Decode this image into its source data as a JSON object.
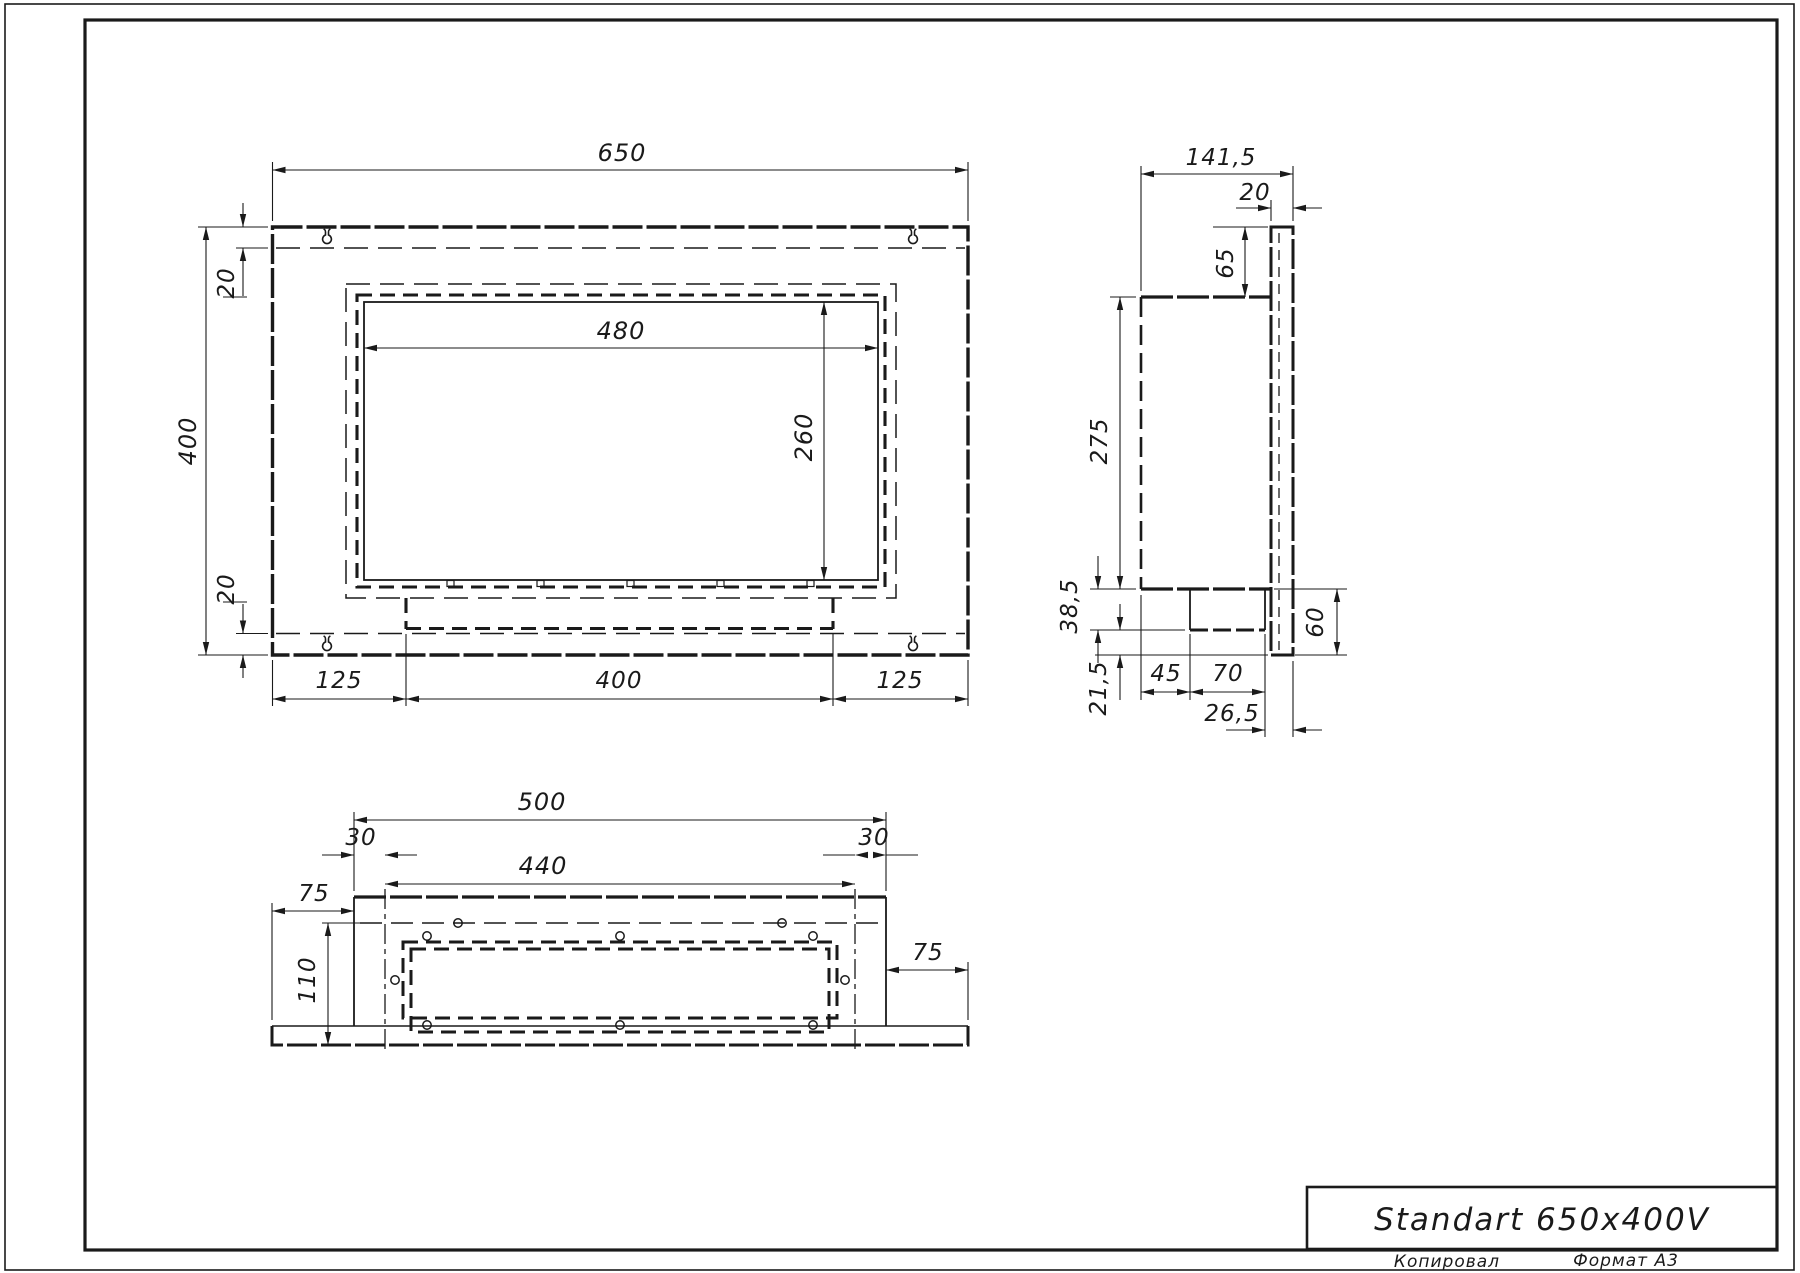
{
  "title_block": {
    "title": "Standart 650x400V"
  },
  "sheet": {
    "copied_label": "Копировал",
    "format_label": "Формат A3"
  },
  "views": {
    "front": {
      "width": "650",
      "height": "400",
      "top_offset": "20",
      "bottom_offset": "20",
      "opening_width": "480",
      "opening_height": "260",
      "margin_left": "125",
      "burner_width": "400",
      "margin_right": "125"
    },
    "side": {
      "depth": "141,5",
      "panel_thickness": "20",
      "flange_top": "65",
      "body_height": "275",
      "burner_drop": "38,5",
      "bottom_gap": "21,5",
      "rear_offset": "45",
      "burner_width": "70",
      "front_offset": "26,5",
      "panel_drop": "60"
    },
    "bottom": {
      "body_width": "500",
      "inset_left": "30",
      "inset_right": "30",
      "insert_width": "440",
      "flange_left": "75",
      "depth": "110",
      "flange_right": "75"
    }
  }
}
